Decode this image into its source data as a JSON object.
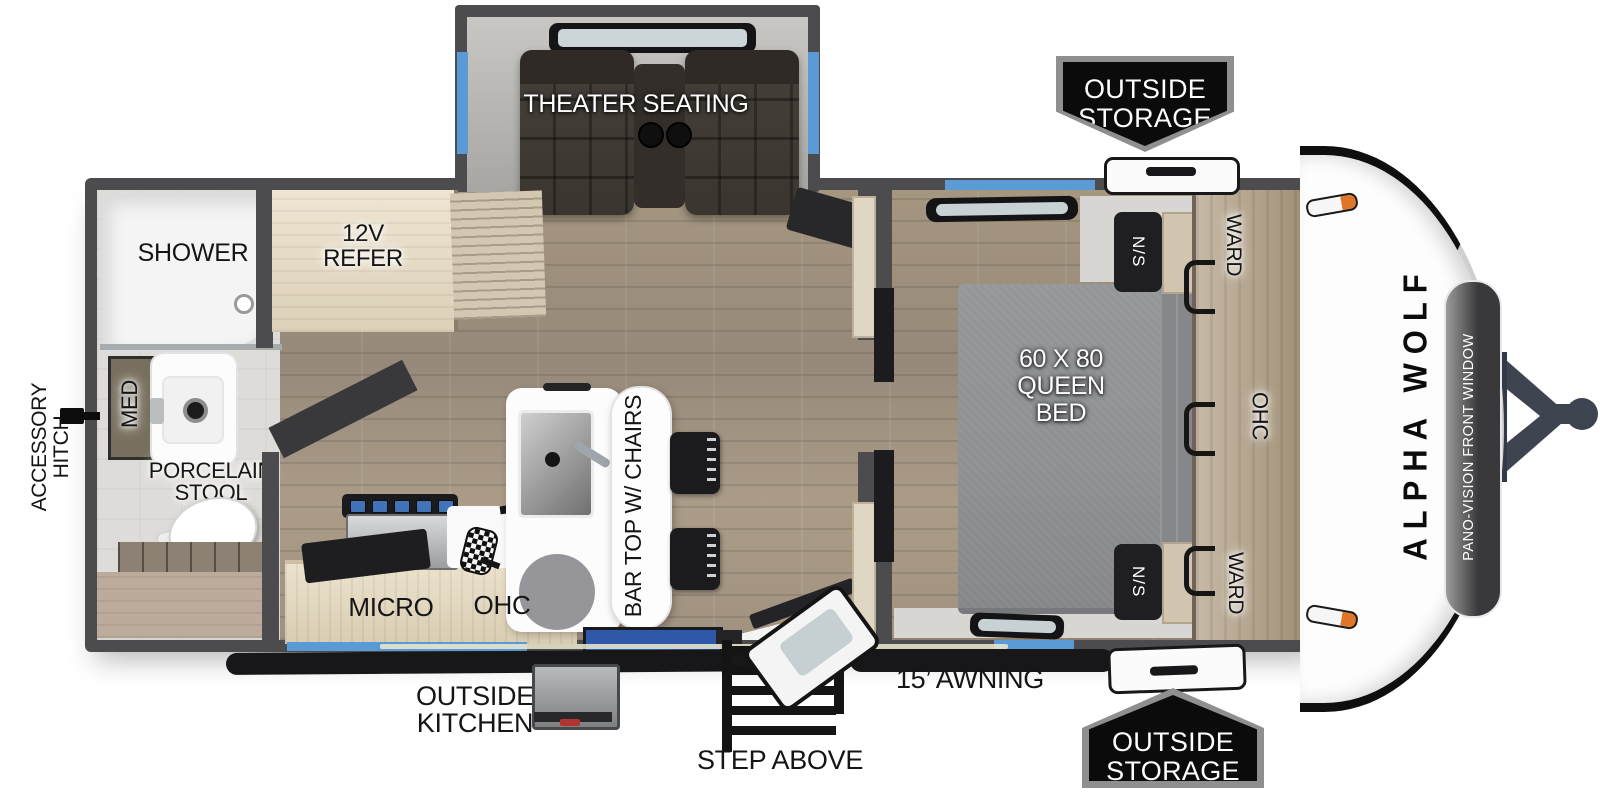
{
  "floorplan": {
    "brand": "ALPHA WOLF",
    "front_window": "PANO-VISION FRONT WINDOW",
    "slideout": {
      "theater": "THEATER SEATING"
    },
    "storage_badge": {
      "line1": "OUTSIDE",
      "line2": "STORAGE"
    },
    "bathroom": {
      "shower": "SHOWER",
      "med": "MED",
      "stool_line1": "PORCELAIN",
      "stool_line2": "STOOL"
    },
    "kitchen": {
      "refer_line1": "12V",
      "refer_line2": "REFER",
      "micro": "MICRO",
      "ohc": "OHC",
      "bar_top": "BAR TOP W/ CHAIRS"
    },
    "bedroom": {
      "bed_line1": "60 X 80",
      "bed_line2": "QUEEN",
      "bed_line3": "BED",
      "nightstand": "N/S",
      "wardrobe": "WARD",
      "ohc": "OHC"
    },
    "exterior": {
      "accessory_hitch_line1": "ACCESSORY",
      "accessory_hitch_line2": "HITCH",
      "outside_kitchen_line1": "OUTSIDE",
      "outside_kitchen_line2": "KITCHEN",
      "step_above": "STEP ABOVE",
      "awning": "15’ AWNING"
    },
    "colors": {
      "window_blue": "#5b9bd5",
      "wall_gray": "#4c4c4e",
      "badge_black": "#0b0b0b",
      "entry_mat_blue": "#2d59a8"
    }
  }
}
